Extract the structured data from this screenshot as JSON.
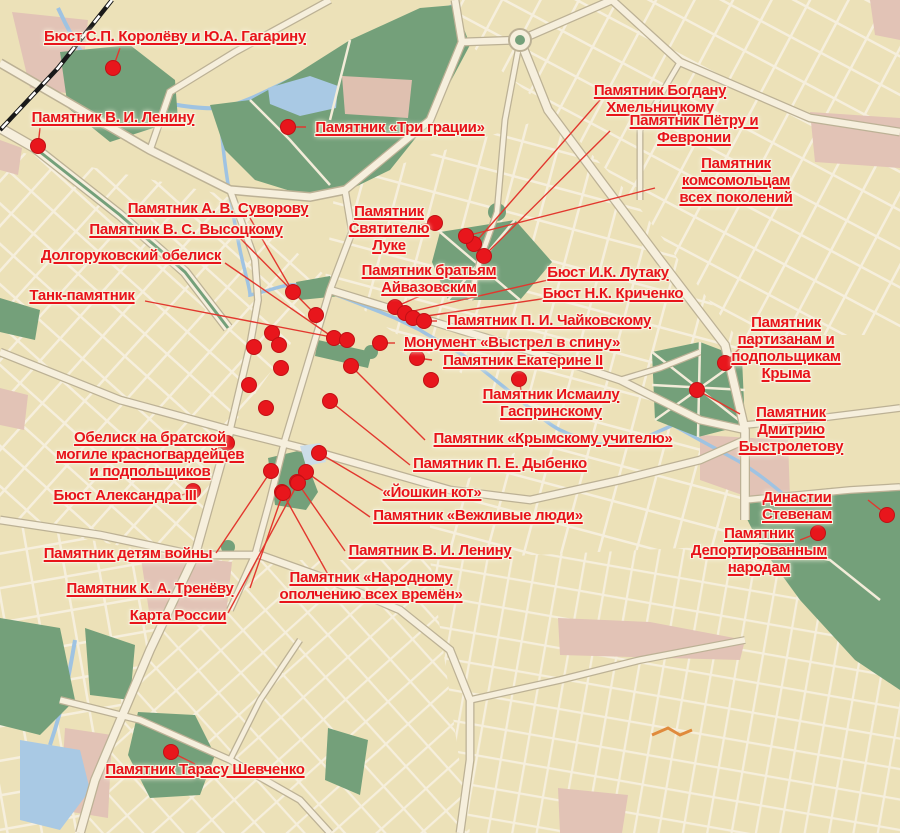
{
  "map": {
    "description": "City street map with red monument markers and leader lines",
    "colors": {
      "background": "#ece1b8",
      "road": "#f6efdd",
      "road_casing": "#bcb195",
      "park_green": "#74a07a",
      "water_blue": "#9fc3e2",
      "pink_zone": "#e2c3b6",
      "railway_black": "#191919",
      "label_red": "#e8131a",
      "dot_red": "#e8161c",
      "leader_line_red": "#e2372e",
      "orange_road": "#e08a3c",
      "pale_blue_block": "#ccdde8"
    },
    "markers": [
      {
        "id": "korolev-gagarin",
        "label": "Бюст С.П. Королёву и Ю.А. Гагарину",
        "dot": {
          "x": 113,
          "y": 68
        },
        "label_pos": {
          "cx": 175,
          "top": 28
        },
        "anchor": {
          "x": 120,
          "y": 48
        }
      },
      {
        "id": "lenin-top",
        "label": "Памятник В. И. Ленину",
        "dot": {
          "x": 38,
          "y": 146
        },
        "label_pos": {
          "cx": 113,
          "top": 109
        },
        "anchor": {
          "x": 40,
          "y": 128
        }
      },
      {
        "id": "tri-gracii",
        "label": "Памятник «Три грации»",
        "dot": {
          "x": 288,
          "y": 127
        },
        "label_pos": {
          "cx": 400,
          "top": 119
        },
        "anchor": {
          "x": 306,
          "y": 127
        }
      },
      {
        "id": "bogdan-khmelnitsky",
        "label": "Памятник Богдану Хмельницкому",
        "dot": {
          "x": 474,
          "y": 244
        },
        "label_pos": {
          "cx": 660,
          "top": 82
        },
        "anchor": {
          "x": 600,
          "y": 100
        }
      },
      {
        "id": "petr-fevronia",
        "label": "Памятник Пётру и Февронии",
        "dot": {
          "x": 484,
          "y": 256
        },
        "label_pos": {
          "cx": 694,
          "top": 112
        },
        "anchor": {
          "x": 610,
          "y": 131
        }
      },
      {
        "id": "komsomol",
        "label": "Памятник комсомольцам\nвсех поколений",
        "dot": {
          "x": 466,
          "y": 236
        },
        "label_pos": {
          "cx": 736,
          "top": 155
        },
        "anchor": {
          "x": 655,
          "y": 188
        }
      },
      {
        "id": "suvorov",
        "label": "Памятник А. В. Суворову",
        "dot": {
          "x": 293,
          "y": 292
        },
        "label_pos": {
          "cx": 218,
          "top": 200
        },
        "anchor": {
          "x": 250,
          "y": 218
        }
      },
      {
        "id": "vysotsky",
        "label": "Памятник В. С. Высоцкому",
        "dot": {
          "x": 316,
          "y": 315
        },
        "label_pos": {
          "cx": 186,
          "top": 221
        },
        "anchor": {
          "x": 240,
          "y": 238
        }
      },
      {
        "id": "dolgorukov-obelisk",
        "label": "Долгоруковский обелиск",
        "dot": {
          "x": 334,
          "y": 338
        },
        "label_pos": {
          "cx": 131,
          "top": 247
        },
        "anchor": {
          "x": 225,
          "y": 263
        }
      },
      {
        "id": "tank",
        "label": "Танк-памятник",
        "dot": {
          "x": 347,
          "y": 340
        },
        "label_pos": {
          "cx": 82,
          "top": 287
        },
        "anchor": {
          "x": 145,
          "y": 301
        }
      },
      {
        "id": "svyatitel-luka",
        "label": "Памятник\nСвятителю\nЛуке",
        "dot": {
          "x": 435,
          "y": 223
        },
        "label_pos": {
          "cx": 389,
          "top": 203
        },
        "anchor": {
          "x": 420,
          "y": 225
        }
      },
      {
        "id": "aivazovsky",
        "label": "Памятник братьям\nАйвазовским",
        "dot": {
          "x": 395,
          "y": 307
        },
        "label_pos": {
          "cx": 429,
          "top": 262
        },
        "anchor": {
          "x": 420,
          "y": 296
        }
      },
      {
        "id": "lutaku",
        "label": "Бюст И.К. Лутаку",
        "dot": {
          "x": 405,
          "y": 313
        },
        "label_pos": {
          "cx": 608,
          "top": 264
        },
        "anchor": {
          "x": 548,
          "y": 280
        }
      },
      {
        "id": "krichenko",
        "label": "Бюст Н.К. Криченко",
        "dot": {
          "x": 413,
          "y": 318
        },
        "label_pos": {
          "cx": 613,
          "top": 285
        },
        "anchor": {
          "x": 548,
          "y": 298
        }
      },
      {
        "id": "chaikovsky",
        "label": "Памятник П. И. Чайковскому",
        "dot": {
          "x": 424,
          "y": 321
        },
        "label_pos": {
          "cx": 549,
          "top": 312
        },
        "anchor": {
          "x": 437,
          "y": 321
        }
      },
      {
        "id": "vystrel-v-spinu",
        "label": "Монумент «Выстрел в спину»",
        "dot": {
          "x": 380,
          "y": 343
        },
        "label_pos": {
          "cx": 512,
          "top": 334
        },
        "anchor": {
          "x": 395,
          "y": 343
        }
      },
      {
        "id": "ekaterina-ii",
        "label": "Памятник Екатерине II",
        "dot": {
          "x": 417,
          "y": 358
        },
        "label_pos": {
          "cx": 523,
          "top": 352
        },
        "anchor": {
          "x": 432,
          "y": 360
        }
      },
      {
        "id": "partisans-crimea",
        "label": "Памятник партизанам и\nподпольщикам Крыма",
        "dot": {
          "x": 725,
          "y": 363
        },
        "label_pos": {
          "cx": 786,
          "top": 314
        },
        "anchor": {
          "x": 742,
          "y": 346
        }
      },
      {
        "id": "gasprinsky",
        "label": "Памятник Исмаилу\nГаспринскому",
        "dot": {
          "x": 519,
          "y": 379
        },
        "label_pos": {
          "cx": 551,
          "top": 386
        },
        "anchor": {
          "x": 521,
          "y": 390
        }
      },
      {
        "id": "bystroletov",
        "label": "Памятник Дмитрию\nБыстролетову",
        "dot": {
          "x": 697,
          "y": 390
        },
        "label_pos": {
          "cx": 791,
          "top": 404
        },
        "anchor": {
          "x": 740,
          "y": 414
        }
      },
      {
        "id": "krymsky-uchitel",
        "label": "Памятник «Крымскому учителю»",
        "dot": {
          "x": 351,
          "y": 366
        },
        "label_pos": {
          "cx": 553,
          "top": 430
        },
        "anchor": {
          "x": 425,
          "y": 440
        }
      },
      {
        "id": "dybenko",
        "label": "Памятник П. Е. Дыбенко",
        "dot": {
          "x": 330,
          "y": 401
        },
        "label_pos": {
          "cx": 500,
          "top": 455
        },
        "anchor": {
          "x": 410,
          "y": 465
        }
      },
      {
        "id": "yoshkin-kot",
        "label": "«Йошкин кот»",
        "dot": {
          "x": 319,
          "y": 453
        },
        "label_pos": {
          "cx": 432,
          "top": 484
        },
        "anchor": {
          "x": 385,
          "y": 492
        }
      },
      {
        "id": "vezhlivye-lyudi",
        "label": "Памятник «Вежливые люди»",
        "dot": {
          "x": 306,
          "y": 472
        },
        "label_pos": {
          "cx": 478,
          "top": 507
        },
        "anchor": {
          "x": 370,
          "y": 517
        }
      },
      {
        "id": "lenin-bottom",
        "label": "Памятник В. И. Ленину",
        "dot": {
          "x": 297,
          "y": 482
        },
        "label_pos": {
          "cx": 430,
          "top": 542
        },
        "anchor": {
          "x": 345,
          "y": 551
        }
      },
      {
        "id": "narodnoe-opolchenie",
        "label": "Памятник «Народному\nополчению всех времён»",
        "dot": {
          "x": 282,
          "y": 492
        },
        "label_pos": {
          "cx": 371,
          "top": 569
        },
        "anchor": {
          "x": 330,
          "y": 578
        }
      },
      {
        "id": "obelisk-bratskaya-mogila",
        "label": "Обелиск на братской\nмогиле красногвардейцев\nи подпольщиков",
        "dot": {
          "x": 227,
          "y": 443
        },
        "label_pos": {
          "cx": 150,
          "top": 429
        },
        "anchor": {
          "x": 215,
          "y": 450
        }
      },
      {
        "id": "alexander-iii",
        "label": "Бюст Александра III",
        "dot": {
          "x": 193,
          "y": 491
        },
        "label_pos": {
          "cx": 125,
          "top": 487
        },
        "anchor": {
          "x": 182,
          "y": 495
        }
      },
      {
        "id": "detyam-voiny",
        "label": "Памятник детям войны",
        "dot": {
          "x": 271,
          "y": 471
        },
        "label_pos": {
          "cx": 128,
          "top": 545
        },
        "anchor": {
          "x": 216,
          "y": 553
        }
      },
      {
        "id": "trenev",
        "label": "Памятник К. А. Тренёву",
        "dot": {
          "x": 283,
          "y": 493
        },
        "label_pos": {
          "cx": 150,
          "top": 580
        },
        "anchor": {
          "x": 250,
          "y": 588
        }
      },
      {
        "id": "karta-rossii",
        "label": "Карта России",
        "dot": {
          "x": 298,
          "y": 483
        },
        "label_pos": {
          "cx": 178,
          "top": 607
        },
        "anchor": {
          "x": 228,
          "y": 613
        }
      },
      {
        "id": "stevenam",
        "label": "Династии Стевенам",
        "dot": {
          "x": 887,
          "y": 515
        },
        "label_pos": {
          "cx": 797,
          "top": 489
        },
        "anchor": {
          "x": 868,
          "y": 500
        }
      },
      {
        "id": "deportirovannym",
        "label": "Памятник\nДепортированным\nнародам",
        "dot": {
          "x": 818,
          "y": 533
        },
        "label_pos": {
          "cx": 759,
          "top": 525
        },
        "anchor": {
          "x": 800,
          "y": 540
        }
      },
      {
        "id": "shevchenko",
        "label": "Памятник Тарасу Шевченко",
        "dot": {
          "x": 171,
          "y": 752
        },
        "label_pos": {
          "cx": 205,
          "top": 761
        },
        "anchor": {
          "x": 195,
          "y": 764
        }
      }
    ],
    "extra_dots": [
      {
        "x": 272,
        "y": 333
      },
      {
        "x": 279,
        "y": 345
      },
      {
        "x": 254,
        "y": 347
      },
      {
        "x": 249,
        "y": 385
      },
      {
        "x": 266,
        "y": 408
      },
      {
        "x": 281,
        "y": 368
      },
      {
        "x": 431,
        "y": 380
      }
    ]
  }
}
